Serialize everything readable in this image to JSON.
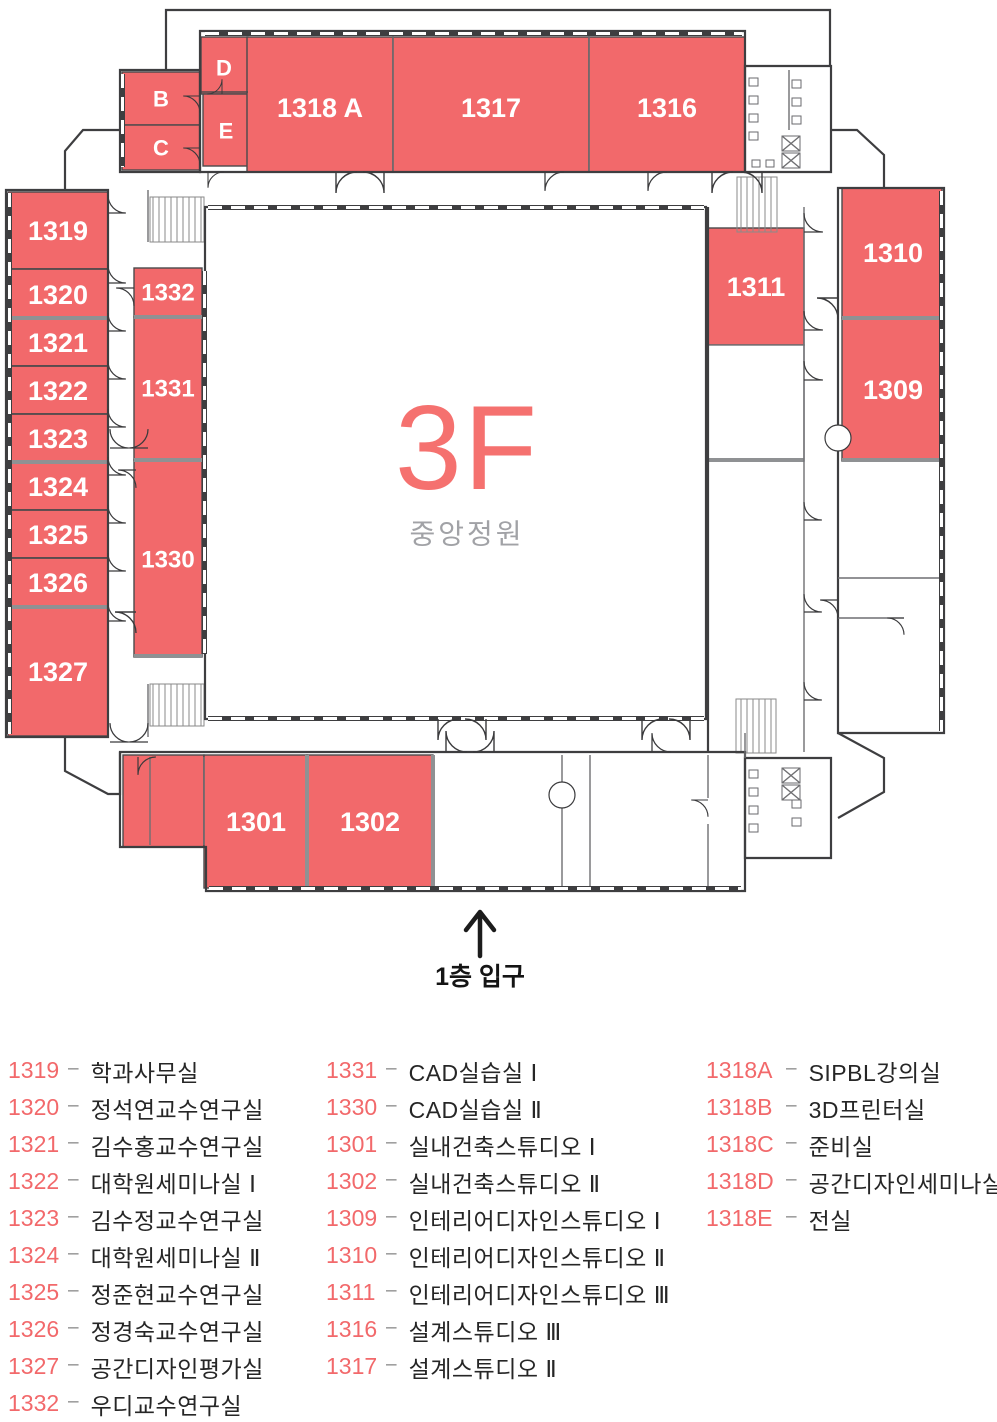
{
  "colors": {
    "accent": "#f2696b",
    "floor_label": "#f5716f",
    "courtyard_text": "#a1a2a6"
  },
  "plan": {
    "floor_label": "3F",
    "courtyard_label": "중앙정원",
    "entrance_label": "1층 입구",
    "room_labels": [
      "B",
      "C",
      "D",
      "E",
      "1318 A",
      "1317",
      "1316",
      "1319",
      "1320",
      "1321",
      "1322",
      "1323",
      "1324",
      "1325",
      "1326",
      "1327",
      "1332",
      "1331",
      "1330",
      "1311",
      "1310",
      "1309",
      "1301",
      "1302"
    ]
  },
  "legend": {
    "separator": "–",
    "columns": [
      {
        "items": [
          {
            "code": "1319",
            "name": "학과사무실"
          },
          {
            "code": "1320",
            "name": "정석연교수연구실"
          },
          {
            "code": "1321",
            "name": "김수홍교수연구실"
          },
          {
            "code": "1322",
            "name": "대학원세미나실 Ⅰ"
          },
          {
            "code": "1323",
            "name": "김수정교수연구실"
          },
          {
            "code": "1324",
            "name": "대학원세미나실 Ⅱ"
          },
          {
            "code": "1325",
            "name": "정준현교수연구실"
          },
          {
            "code": "1326",
            "name": "정경숙교수연구실"
          },
          {
            "code": "1327",
            "name": "공간디자인평가실"
          },
          {
            "code": "1332",
            "name": "우디교수연구실"
          }
        ]
      },
      {
        "items": [
          {
            "code": "1331",
            "name": "CAD실습실 Ⅰ"
          },
          {
            "code": "1330",
            "name": "CAD실습실 Ⅱ"
          },
          {
            "code": "1301",
            "name": "실내건축스튜디오 Ⅰ"
          },
          {
            "code": "1302",
            "name": "실내건축스튜디오 Ⅱ"
          },
          {
            "code": "1309",
            "name": "인테리어디자인스튜디오 Ⅰ"
          },
          {
            "code": "1310",
            "name": "인테리어디자인스튜디오 Ⅱ"
          },
          {
            "code": "1311",
            "name": "인테리어디자인스튜디오 Ⅲ"
          },
          {
            "code": "1316",
            "name": "설계스튜디오 Ⅲ"
          },
          {
            "code": "1317",
            "name": "설계스튜디오 Ⅱ"
          }
        ]
      },
      {
        "items": [
          {
            "code": "1318A",
            "name": "SIPBL강의실"
          },
          {
            "code": "1318B",
            "name": "3D프린터실"
          },
          {
            "code": "1318C",
            "name": "준비실"
          },
          {
            "code": "1318D",
            "name": "공간디자인세미나실"
          },
          {
            "code": "1318E",
            "name": "전실"
          }
        ]
      }
    ]
  }
}
